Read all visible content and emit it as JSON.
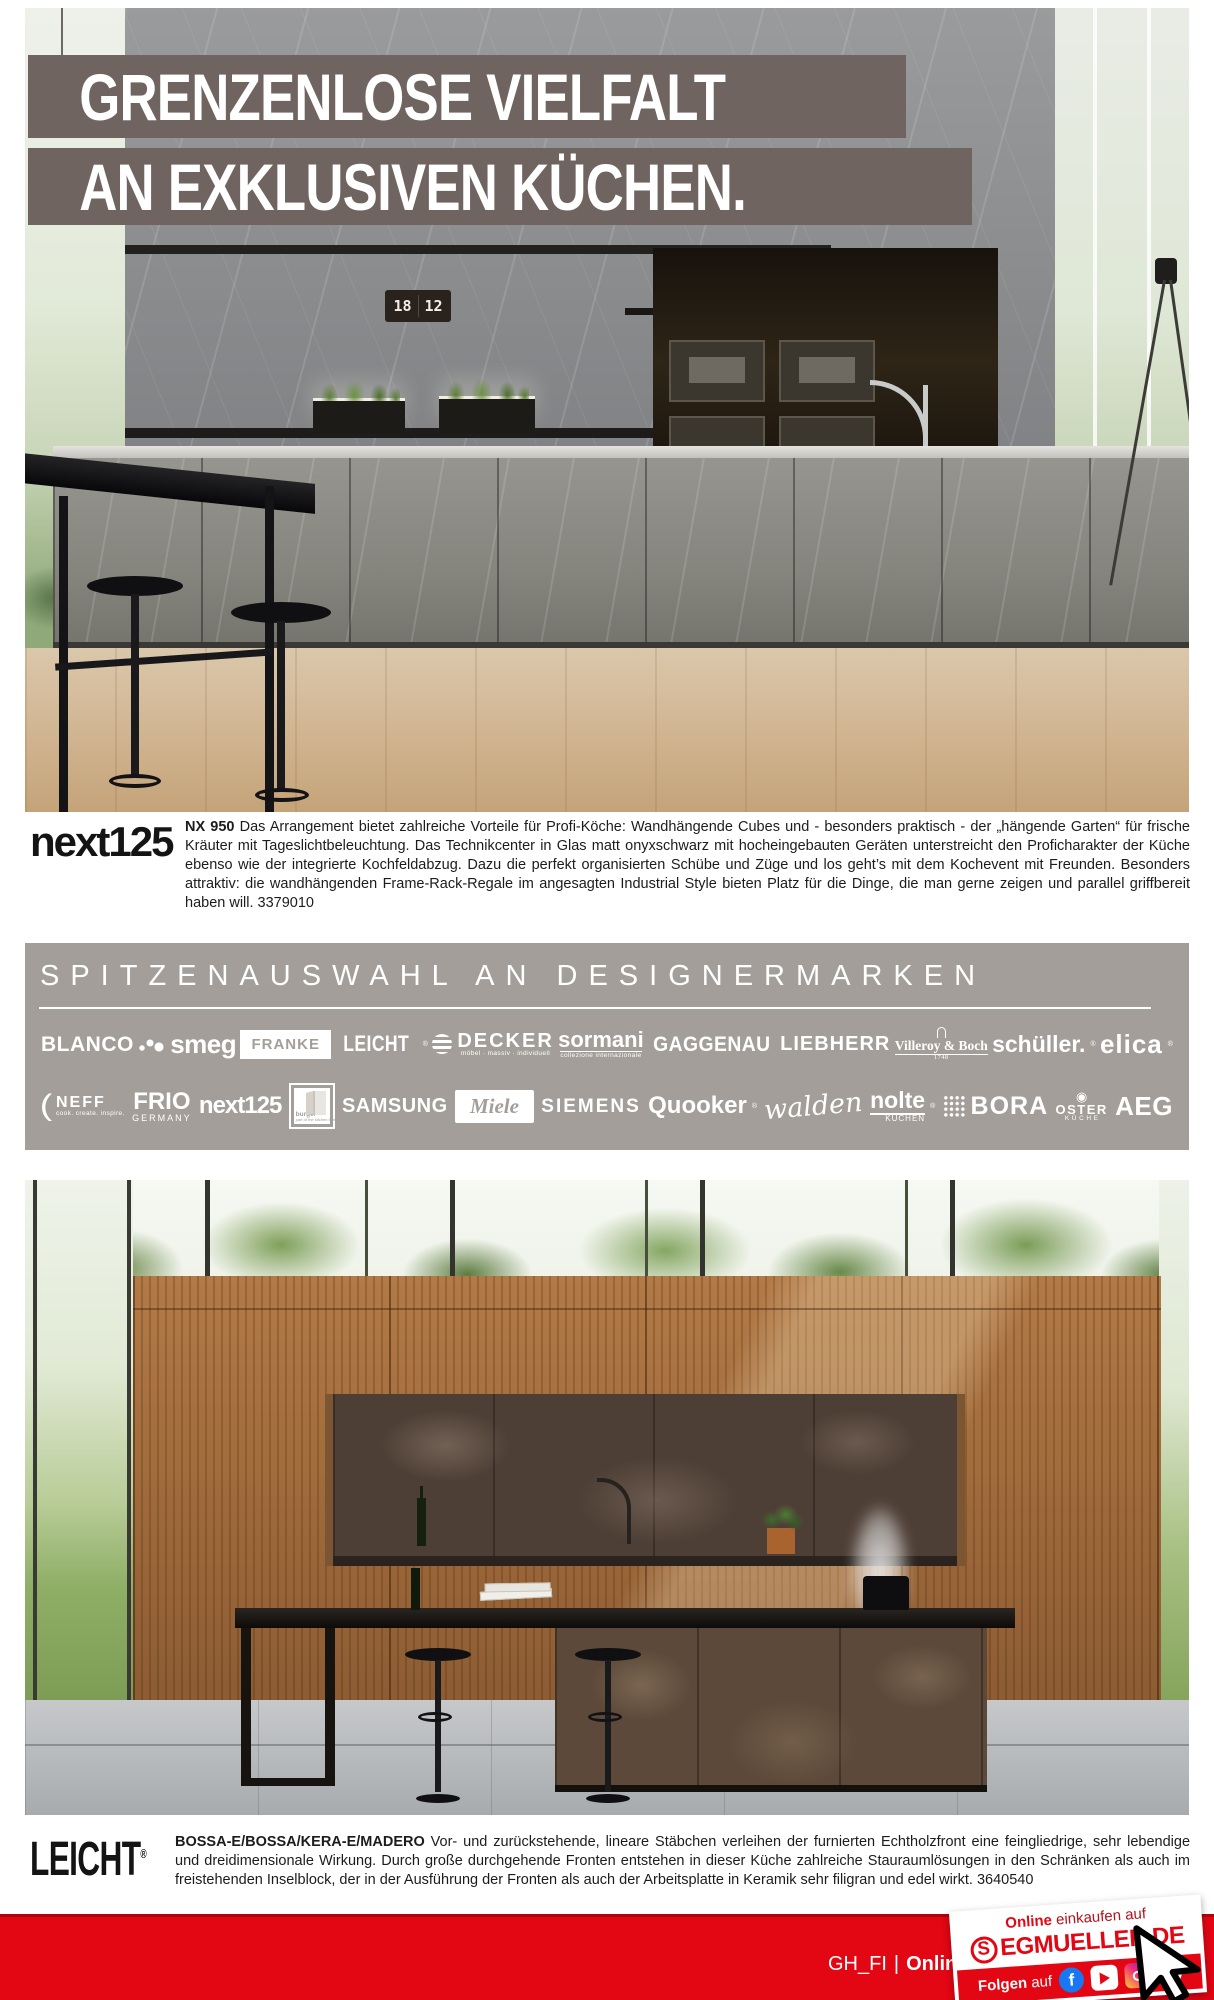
{
  "headline": {
    "line1": "GRENZENLOSE VIELFALT",
    "line2": "AN EXKLUSIVEN KÜCHEN."
  },
  "hero": {
    "clock_hours": "18",
    "clock_minutes": "12"
  },
  "next125_section": {
    "logo": "next125",
    "lead": "NX 950",
    "body": "Das Arrangement bietet zahlreiche Vorteile für Profi-Köche: Wandhängende Cubes und - besonders praktisch - der „hängende Garten“ für frische Kräuter mit Tageslichtbeleuchtung. Das Technikcenter in Glas matt onyxschwarz mit hocheingebauten Geräten unterstreicht den Proficharakter der Küche ebenso wie der integrierte Kochfeldabzug. Dazu die perfekt organisierten Schübe und Züge und los geht’s mit dem Kochevent mit Freunden. Besonders attraktiv: die wandhängenden Frame-Rack-Regale im angesagten Industrial Style bieten Platz für die Dinge, die man gerne zeigen und parallel griffbereit haben will. 3379010"
  },
  "brands": {
    "title": "SPITZENAUSWAHL AN DESIGNERMARKEN",
    "row1": [
      {
        "label": "BLANCO"
      },
      {
        "label": "smeg"
      },
      {
        "label": "FRANKE"
      },
      {
        "label": "LEICHT",
        "reg": "®"
      },
      {
        "label": "DECKER",
        "sub": "möbel · massiv · individuell"
      },
      {
        "label": "sormani",
        "sub": "collezione internazionale"
      },
      {
        "label": "GAGGENAU"
      },
      {
        "label": "LIEBHERR"
      },
      {
        "label": "Villeroy & Boch",
        "sub": "1748"
      },
      {
        "label": "schüller.",
        "reg": "®"
      },
      {
        "label": "elica",
        "reg": "®"
      }
    ],
    "row2": [
      {
        "label": "NEFF",
        "sub": "cook. create. inspire."
      },
      {
        "label": "FRIO",
        "sub": "GERMANY"
      },
      {
        "label": "next125"
      },
      {
        "label": "burger",
        "sub": "part of the kitchen family"
      },
      {
        "label": "SAMSUNG"
      },
      {
        "label": "Miele"
      },
      {
        "label": "SIEMENS"
      },
      {
        "label": "Quooker",
        "reg": "®"
      },
      {
        "label": "walden"
      },
      {
        "label": "nolte",
        "sub": "KÜCHEN",
        "reg": "®"
      },
      {
        "label": "BORA"
      },
      {
        "label": "OSTER",
        "sub": "K Ü C H E",
        "reg": "®",
        "icon": "◉"
      },
      {
        "label": "AEG"
      }
    ]
  },
  "leicht_section": {
    "logo": "LEICHT",
    "reg": "®",
    "lead": "BOSSA-E/BOSSA/KERA-E/MADERO",
    "body": "Vor- und zurückstehende, lineare Stäbchen verleihen der furnierten Echtholzfront eine feingliedrige, sehr lebendige und dreidimensionale Wirkung. Durch große durchgehende Fronten entstehen in dieser Küche zahlreiche Stauraumlösungen in den Schränken als auch im freistehenden Inselblock, der in der Ausführung der Fronten als auch der Arbeitsplatte in Keramik sehr filigran und edel wirkt. 3640540"
  },
  "footer": {
    "page_code": "GH_FI",
    "separator": "|",
    "online": "Online",
    "promo": {
      "line1_bold": "Online",
      "line1_rest": "einkaufen auf",
      "logo_s": "S",
      "logo_rest": "EGMUELLER.DE",
      "follow_bold": "Folgen",
      "follow_rest": "auf",
      "facebook_letter": "f",
      "pinterest_letter": "P"
    }
  },
  "colors": {
    "accent_red": "#e30613",
    "headline_band": "#6f6460",
    "brand_band": "#a39e99"
  }
}
